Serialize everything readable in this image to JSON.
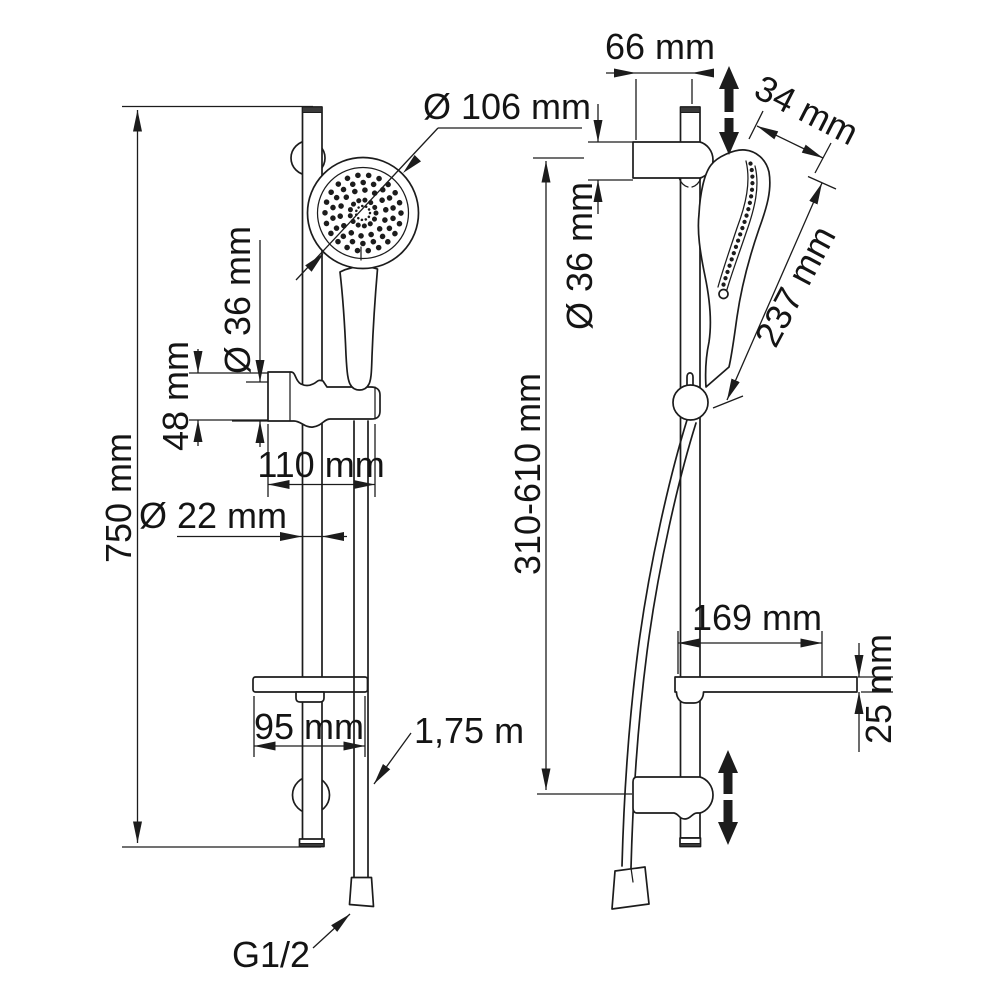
{
  "drawing": {
    "kind": "technical dimension drawing",
    "subject": "shower slide-rail set with hand shower, holder, soap dish and hose",
    "views": [
      "front view",
      "side view"
    ],
    "colors": {
      "background": "#ffffff",
      "line": "#1c1c1c"
    }
  },
  "labels": {
    "overall_height": "750 mm",
    "head_diameter": "Ø 106 mm",
    "holder_diameter_front": "Ø 36 mm",
    "holder_height": "48 mm",
    "holder_width": "110 mm",
    "rail_diameter": "Ø 22 mm",
    "dish_width": "95 mm",
    "hose_length": "1,75 m",
    "thread_size": "G1/2",
    "wall_offset": "66 mm",
    "head_thickness": "34 mm",
    "holder_diameter_side": "Ø 36 mm",
    "handshower_length": "237 mm",
    "adjustment_range": "310-610 mm",
    "dish_depth": "169 mm",
    "dish_thickness": "25 mm"
  }
}
